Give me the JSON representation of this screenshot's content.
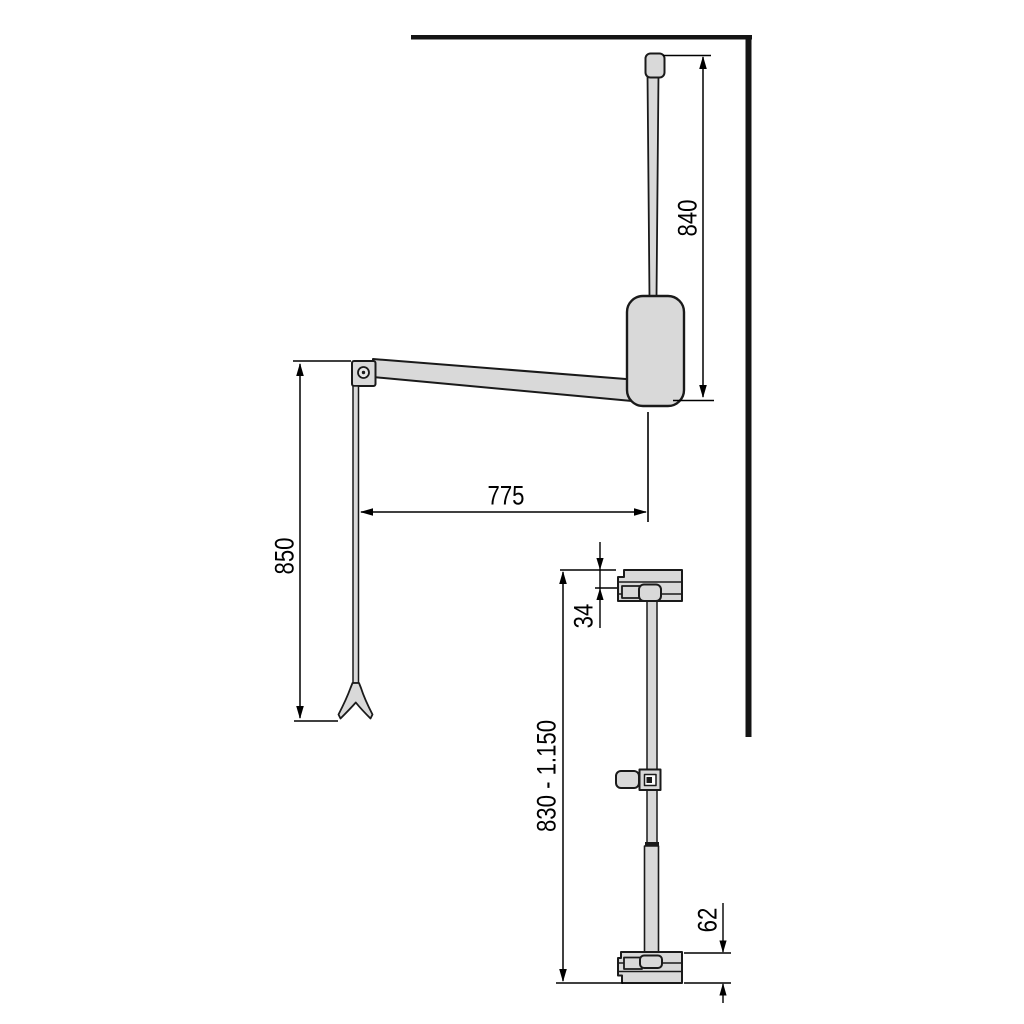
{
  "figure": {
    "title": "wardrobe-lift-dimension-drawing",
    "dim_840": "840",
    "dim_775": "775",
    "dim_850": "850",
    "dim_34": "34",
    "dim_830_1150": "830 - 1.150",
    "dim_62": "62"
  },
  "colors": {
    "outline": "#1a1a1a",
    "metal_fill": "#d9d9d9",
    "dimension_line": "#000000",
    "background": "#ffffff"
  }
}
